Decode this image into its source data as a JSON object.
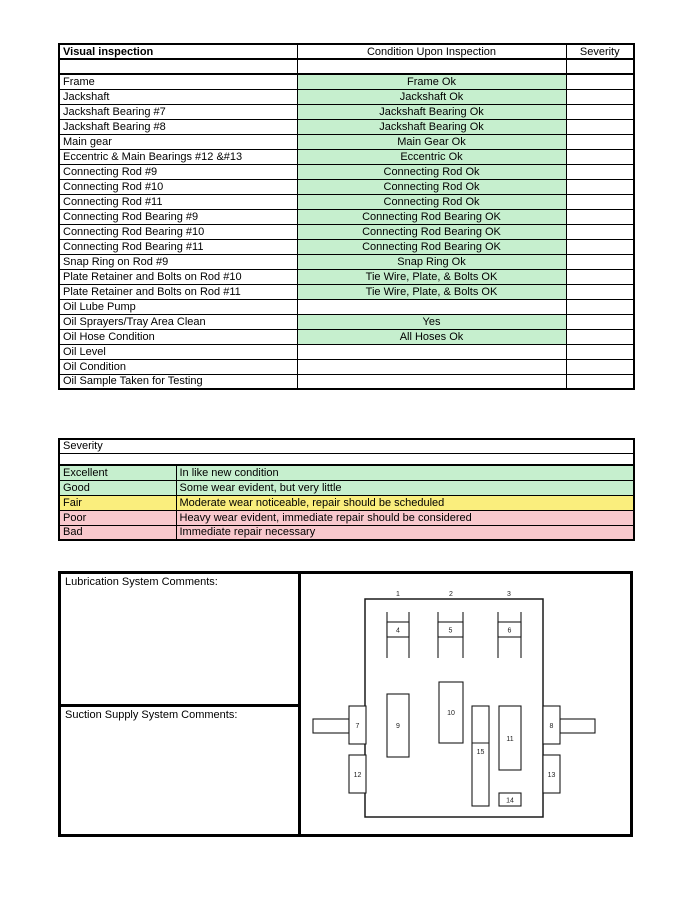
{
  "inspection_table": {
    "headers": {
      "item": "Visual inspection",
      "condition": "Condition Upon Inspection",
      "severity": "Severity"
    },
    "rows": [
      {
        "item": "",
        "condition": "",
        "ok": false,
        "thick": true
      },
      {
        "item": "Frame",
        "condition": "Frame Ok",
        "ok": true
      },
      {
        "item": "Jackshaft",
        "condition": "Jackshaft Ok",
        "ok": true
      },
      {
        "item": "Jackshaft Bearing #7",
        "condition": "Jackshaft Bearing Ok",
        "ok": true
      },
      {
        "item": "Jackshaft Bearing #8",
        "condition": "Jackshaft Bearing Ok",
        "ok": true
      },
      {
        "item": "Main gear",
        "condition": "Main Gear Ok",
        "ok": true
      },
      {
        "item": "Eccentric & Main Bearings #12 &#13",
        "condition": "Eccentric Ok",
        "ok": true
      },
      {
        "item": "Connecting Rod #9",
        "condition": "Connecting Rod Ok",
        "ok": true
      },
      {
        "item": "Connecting Rod #10",
        "condition": "Connecting Rod Ok",
        "ok": true
      },
      {
        "item": "Connecting Rod #11",
        "condition": "Connecting Rod Ok",
        "ok": true
      },
      {
        "item": "Connecting Rod Bearing #9",
        "condition": "Connecting Rod Bearing OK",
        "ok": true
      },
      {
        "item": "Connecting Rod Bearing #10",
        "condition": "Connecting Rod Bearing OK",
        "ok": true
      },
      {
        "item": "Connecting Rod Bearing #11",
        "condition": "Connecting Rod Bearing OK",
        "ok": true
      },
      {
        "item": "Snap Ring on Rod #9",
        "condition": "Snap Ring Ok",
        "ok": true
      },
      {
        "item": "Plate Retainer and Bolts on Rod #10",
        "condition": "Tie Wire, Plate, & Bolts OK",
        "ok": true
      },
      {
        "item": "Plate Retainer and Bolts on Rod #11",
        "condition": "Tie Wire, Plate, & Bolts OK",
        "ok": true
      },
      {
        "item": "Oil Lube Pump",
        "condition": "",
        "ok": false
      },
      {
        "item": "Oil Sprayers/Tray Area Clean",
        "condition": "Yes",
        "ok": true
      },
      {
        "item": "Oil Hose Condition",
        "condition": "All Hoses Ok",
        "ok": true
      },
      {
        "item": "Oil Level",
        "condition": "",
        "ok": false
      },
      {
        "item": "Oil Condition",
        "condition": "",
        "ok": false
      },
      {
        "item": "Oil Sample Taken for Testing",
        "condition": "",
        "ok": false
      }
    ]
  },
  "severity_table": {
    "title": "Severity",
    "levels": [
      {
        "label": "Excellent",
        "description": "In like new condition",
        "color": "green"
      },
      {
        "label": "Good",
        "description": "Some wear evident, but very little",
        "color": "green"
      },
      {
        "label": "Fair",
        "description": "Moderate wear noticeable, repair should be scheduled",
        "color": "yellow"
      },
      {
        "label": "Poor",
        "description": "Heavy wear evident, immediate repair should be considered",
        "color": "pink"
      },
      {
        "label": "Bad",
        "description": "Immediate repair necessary",
        "color": "pink"
      }
    ]
  },
  "comments": {
    "lubrication_label": "Lubrication System Comments:",
    "suction_label": "Suction Supply System Comments:"
  },
  "diagram": {
    "labels": [
      "1",
      "2",
      "3",
      "4",
      "5",
      "6",
      "7",
      "8",
      "9",
      "10",
      "11",
      "12",
      "13",
      "14",
      "15"
    ]
  },
  "colors": {
    "ok_green": "#C6EFCE",
    "level_green": "#C6EFCE",
    "level_yellow": "#FAEE7D",
    "level_pink": "#F8C8CD"
  }
}
